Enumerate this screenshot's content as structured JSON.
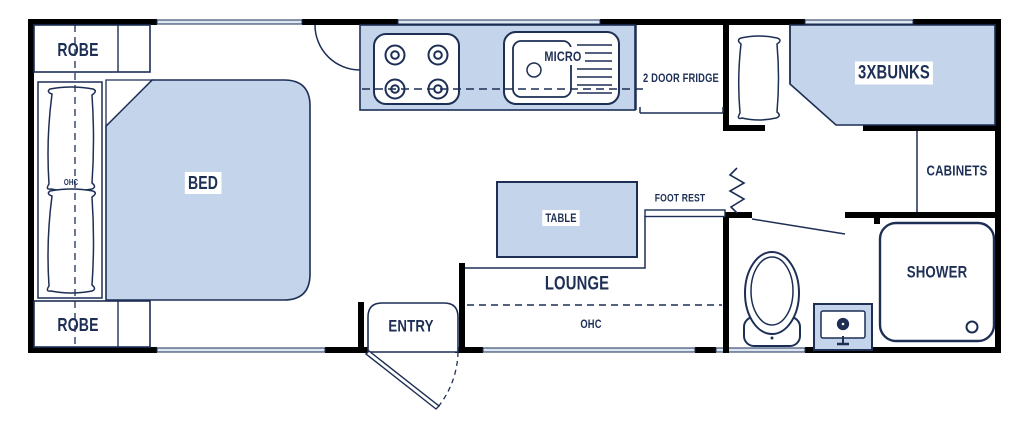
{
  "colors": {
    "fixture_fill": "#c4d4ea",
    "line": "#1d2f55",
    "wall": "#000000",
    "window_fill": "#dce5f2",
    "background": "#ffffff",
    "label_text": "#1d2f55"
  },
  "floorplan": {
    "front_bedroom": {
      "robe_top": "ROBE",
      "robe_bottom": "ROBE",
      "bed": "BED",
      "ohc_over_bed": "OHC"
    },
    "kitchen": {
      "micro": "MICRO",
      "fridge": "2 DOOR FRIDGE"
    },
    "dinette": {
      "table": "TABLE",
      "foot_rest": "FOOT REST",
      "lounge": "LOUNGE",
      "ohc": "OHC"
    },
    "entry": {
      "label": "ENTRY"
    },
    "bunk_room": {
      "bunks": "3XBUNKS",
      "cabinets": "CABINETS"
    },
    "bathroom": {
      "shower": "SHOWER"
    }
  }
}
